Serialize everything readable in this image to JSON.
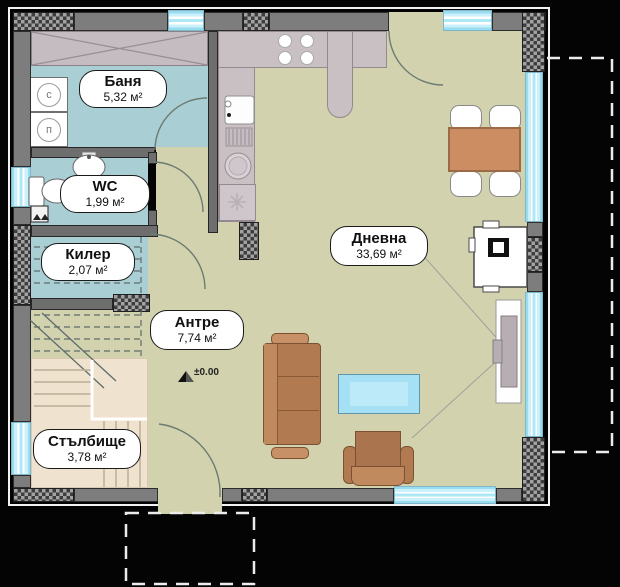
{
  "rooms": [
    {
      "name": "Баня",
      "area": "5,32 м²"
    },
    {
      "name": "WC",
      "area": "1,99 м²"
    },
    {
      "name": "Килер",
      "area": "2,07 м²"
    },
    {
      "name": "Антре",
      "area": "7,74 м²"
    },
    {
      "name": "Дневна",
      "area": "33,69 м²"
    },
    {
      "name": "Стълбище",
      "area": "3,78 м²"
    }
  ],
  "annotations": {
    "level_marker": "±0.00"
  },
  "appliances": {
    "washer": "с",
    "dryer": "п"
  },
  "colors": {
    "background": "#040404",
    "floor_main": "#d2d3ae",
    "floor_wet": "#a9ced3",
    "floor_stairs": "#efe3d0",
    "wall_gray": "#7d7d7d",
    "window_cyan": "#aee7f6",
    "kitchen_counter": "#c9c0c4",
    "furniture_wood": "#cd8d62",
    "sofa_brown": "#b27a50",
    "coffee_table_blue": "#a5e0f4"
  }
}
